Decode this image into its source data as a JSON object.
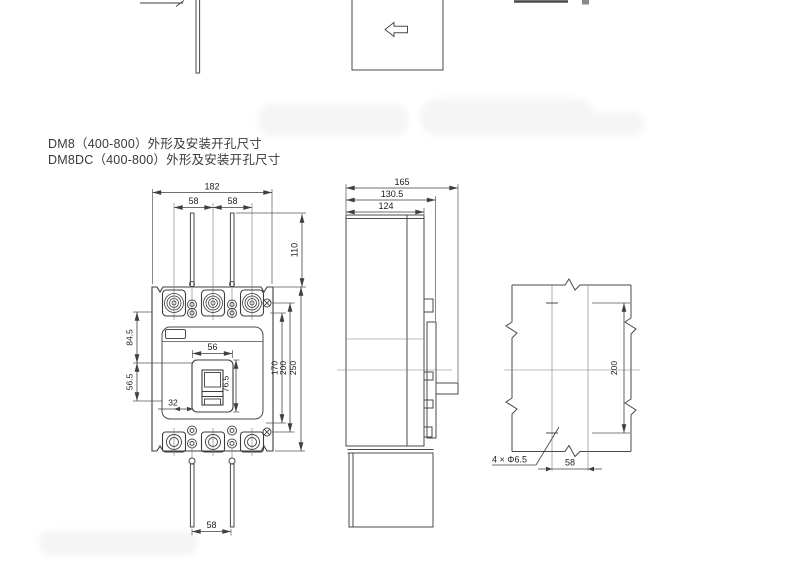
{
  "titles": {
    "line1": "DM8（400-800）外形及安装开孔尺寸",
    "line2": "DM8DC（400-800）外形及安装开孔尺寸"
  },
  "front_view": {
    "dim_total_width": "182",
    "dim_pole_pitch_left": "58",
    "dim_pole_pitch_right": "58",
    "dim_terminal_extension": "110",
    "dim_cover_top": "84.5",
    "dim_cover_mid": "56.5",
    "dim_handle_window_width": "56",
    "dim_handle_window_height": "76.5",
    "dim_handle_offset": "32",
    "dim_height_inner": "170",
    "dim_height_mounting": "200",
    "dim_height_total": "250",
    "dim_bottom_terminal_pitch": "58"
  },
  "side_view": {
    "dim_depth_total": "165",
    "dim_depth_front": "130.5",
    "dim_depth_case": "124"
  },
  "drill_view": {
    "dim_hole_rows": "200",
    "dim_hole_cols": "58",
    "callout_holes": "4 × Φ6.5"
  }
}
